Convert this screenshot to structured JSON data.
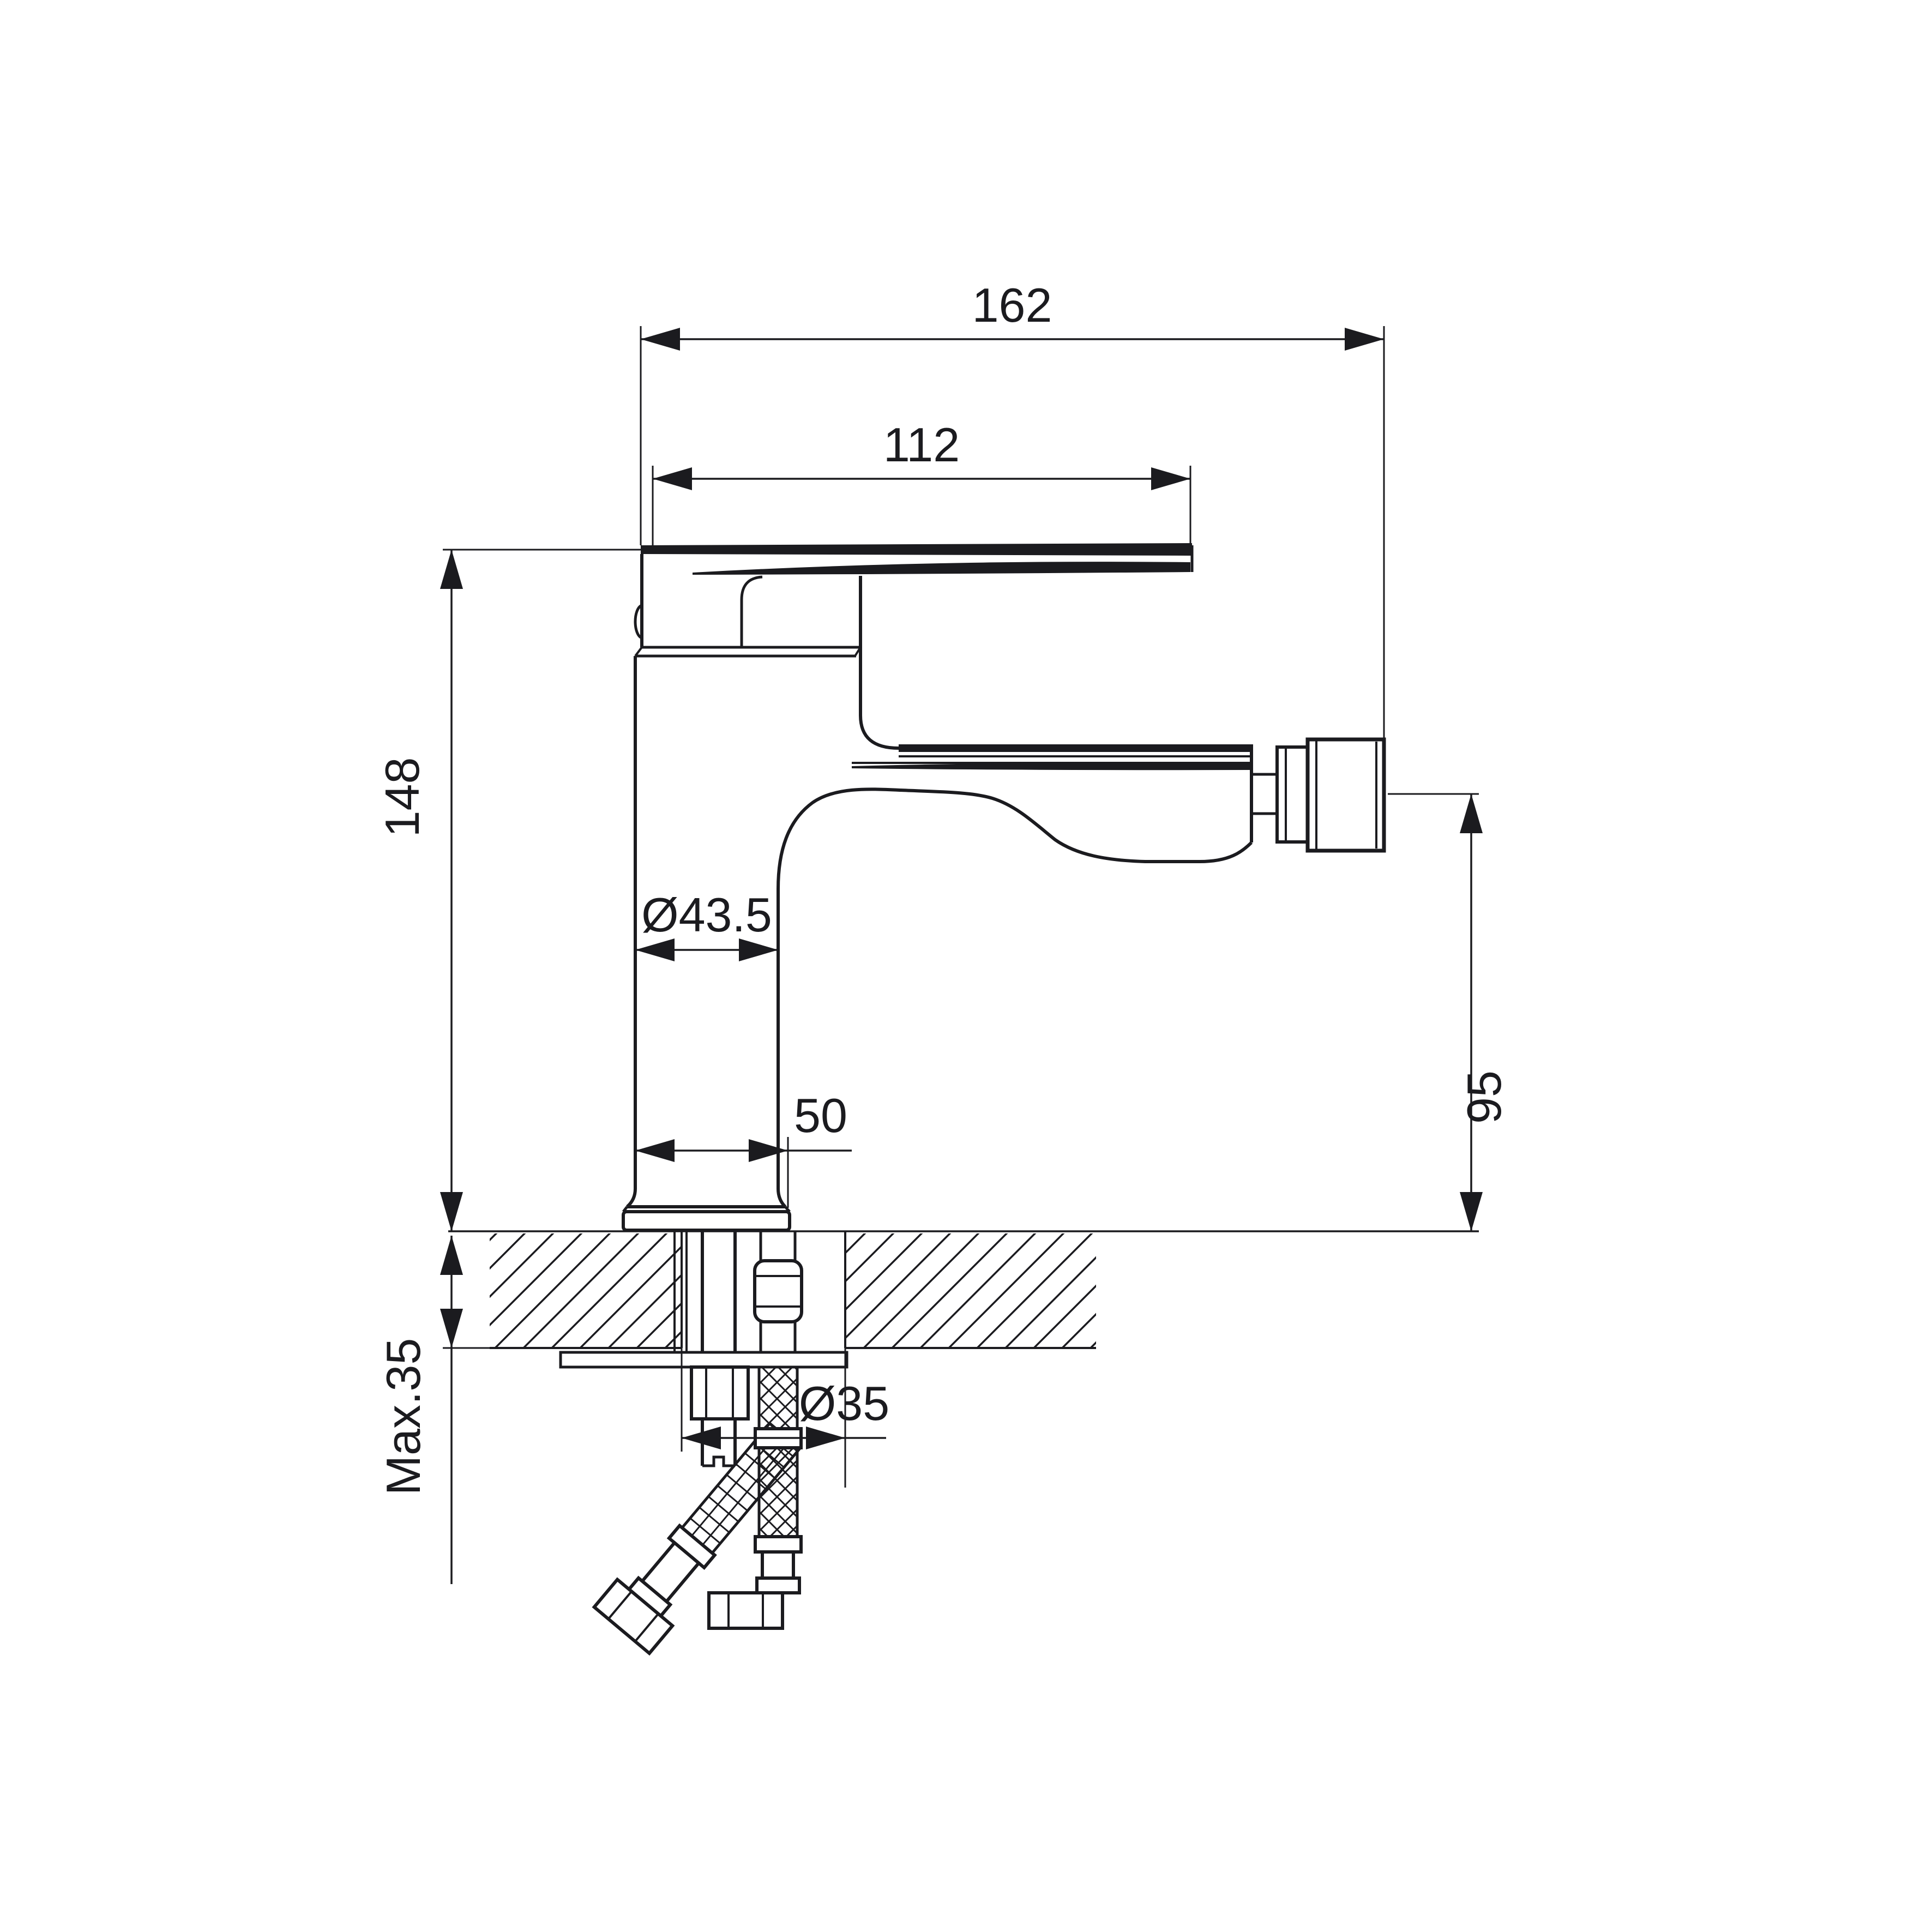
{
  "page": {
    "background": "#ffffff",
    "line_color": "#1b1b1f"
  },
  "drawing": {
    "labels": {
      "overall_length": "162",
      "handle_length": "112",
      "body_height": "148",
      "body_diameter": "Ø43.5",
      "base_width": "50",
      "spout_height": "95",
      "hole_diameter": "Ø35",
      "deck_thickness": "Max.35"
    }
  }
}
